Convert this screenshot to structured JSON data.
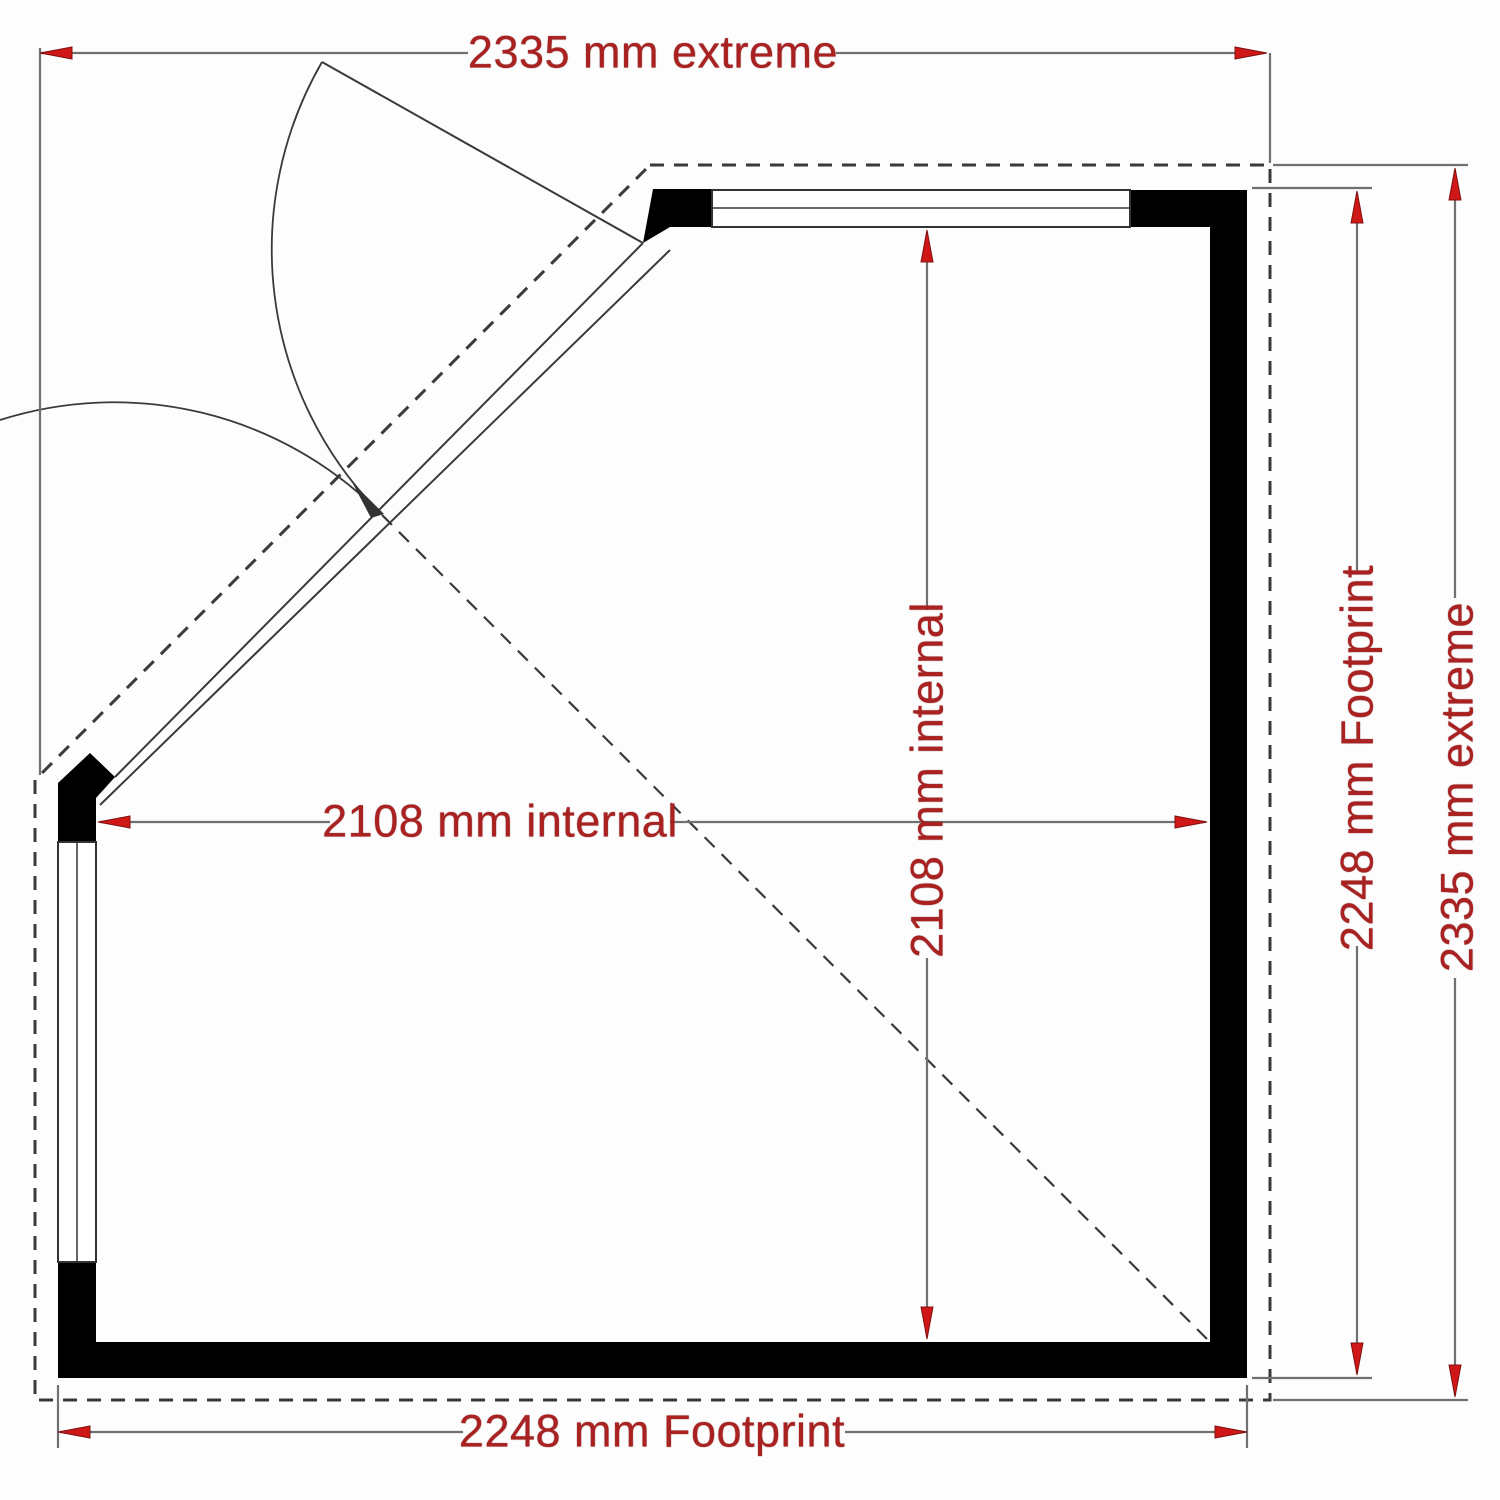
{
  "document": {
    "type": "floor-plan",
    "title": "Corner summerhouse floor plan"
  },
  "labels": {
    "top_extreme": "2335 mm extreme",
    "bottom_footprint": "2248 mm Footprint",
    "internal_width": "2108 mm internal",
    "internal_depth": "2108 mm internal",
    "right_footprint": "2248 mm Footprint",
    "right_extreme": "2335 mm extreme"
  },
  "dimensions_mm": {
    "extreme_width": 2335,
    "extreme_depth": 2335,
    "footprint_width": 2248,
    "footprint_depth": 2248,
    "internal_width": 2108,
    "internal_depth": 2108
  },
  "colors": {
    "dimension_text": "#a92121",
    "arrow_fill": "#cf1717",
    "arrow_outline": "#801010",
    "wall": "#000000",
    "dimension_line": "#707070",
    "outline_line": "#3a3a3a",
    "background": "#fdfdfd"
  }
}
